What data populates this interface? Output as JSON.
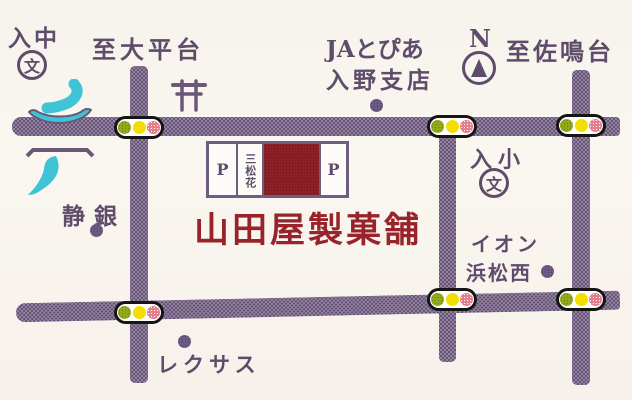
{
  "map": {
    "shop_name": "山田屋製菓舗",
    "building": {
      "parking_left": "P",
      "parking_right": "P",
      "tenant": "三松花"
    },
    "labels": {
      "irino_jhs": "入中",
      "school_mark": "文",
      "to_daiheidai": "至大平台",
      "ja_topia": "JAとぴあ",
      "irino_branch": "入野支店",
      "north": "N",
      "to_sanarudai": "至佐鳴台",
      "irino_es": "入小",
      "shizugin": "静銀",
      "aeon_line1": "イオン",
      "aeon_line2": "浜松西",
      "lexus": "レクサス"
    },
    "colors": {
      "road": "#94839e",
      "road_dot": "#58456c",
      "label_purple": "#5f4c6a",
      "brand_red": "#97242a",
      "building_red": "#8b2126",
      "water_cyan": "#3fc3d6",
      "signal_green": "#93a91c",
      "signal_yellow": "#f2df00",
      "signal_red": "#e4808e",
      "background": "#f8f4ee"
    }
  }
}
